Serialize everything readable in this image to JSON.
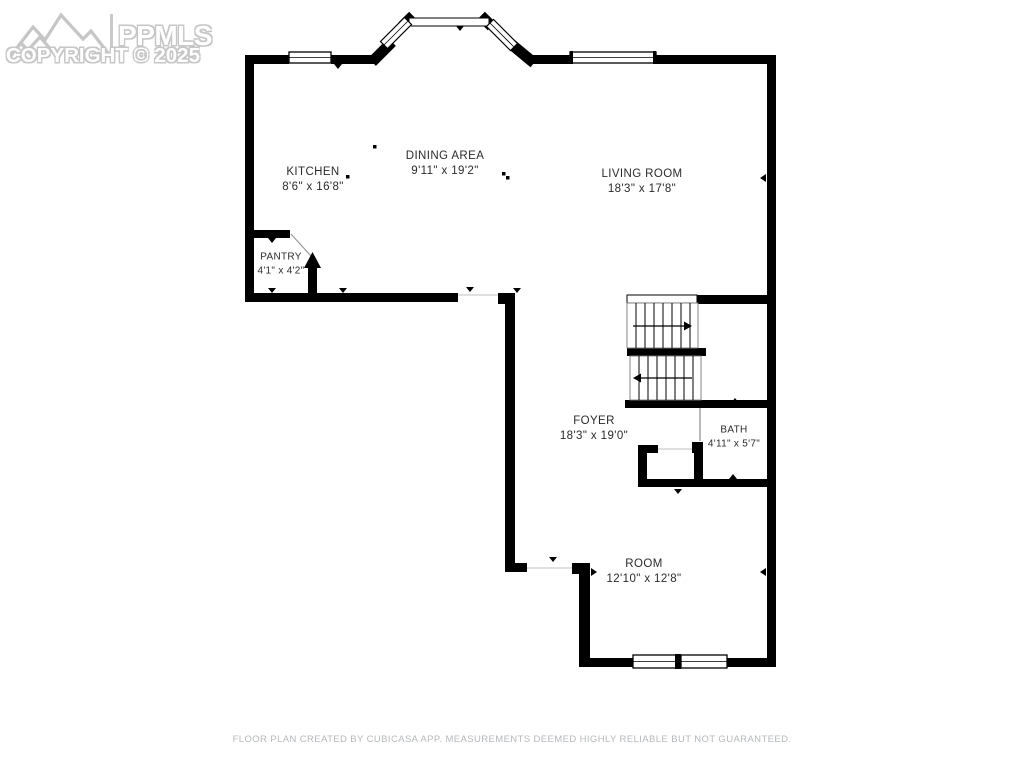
{
  "watermark": {
    "brand": "PPMLS",
    "copyright": "COPYRIGHT © 2025"
  },
  "rooms": [
    {
      "name": "KITCHEN",
      "dims": "8'6\" x 16'8\""
    },
    {
      "name": "DINING AREA",
      "dims": "9'11\" x 19'2\""
    },
    {
      "name": "LIVING ROOM",
      "dims": "18'3\" x 17'8\""
    },
    {
      "name": "PANTRY",
      "dims": "4'1\" x 4'2\""
    },
    {
      "name": "FOYER",
      "dims": "18'3\" x 19'0\""
    },
    {
      "name": "BATH",
      "dims": "4'11\" x 5'7\""
    },
    {
      "name": "ROOM",
      "dims": "12'10\" x 12'8\""
    }
  ],
  "footer": {
    "disclaimer": "FLOOR PLAN CREATED BY CUBICASA APP. MEASUREMENTS DEEMED HIGHLY RELIABLE BUT NOT GUARANTEED."
  },
  "colors": {
    "wall": "#000000",
    "label_text": "#2b2b2b",
    "watermark": "#c6c6c6",
    "footer_text": "#b5b8bb",
    "background": "#ffffff"
  }
}
